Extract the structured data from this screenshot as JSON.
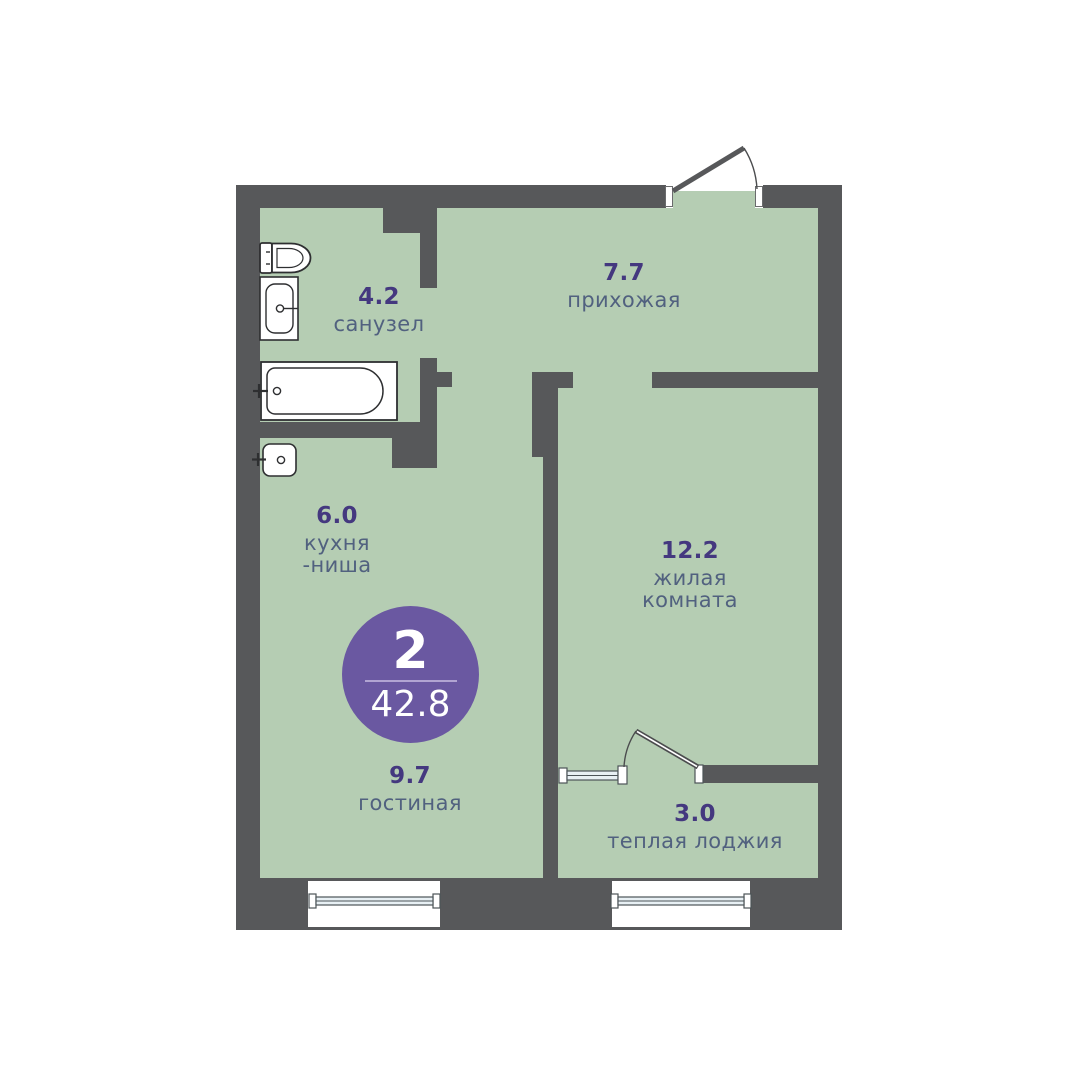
{
  "badge": {
    "rooms_count": "2",
    "total_area": "42.8"
  },
  "rooms": [
    {
      "area": "4.2",
      "name": "санузел"
    },
    {
      "area": "7.7",
      "name": "прихожая"
    },
    {
      "area": "6.0",
      "name": "кухня",
      "name2": "-ниша"
    },
    {
      "area": "12.2",
      "name": "жилая",
      "name2": "комната"
    },
    {
      "area": "9.7",
      "name": "гостиная"
    },
    {
      "area": "3.0",
      "name": "теплая лоджия"
    }
  ],
  "fixtures": [
    "toilet-icon",
    "washbasin-icon",
    "bathtub-icon",
    "kitchen-sink-icon"
  ],
  "colors": {
    "wall": "#57585a",
    "floor": "#b5cdb3",
    "badge": "#6a58a1",
    "area_number": "#44387f",
    "room_label": "#51617f"
  }
}
